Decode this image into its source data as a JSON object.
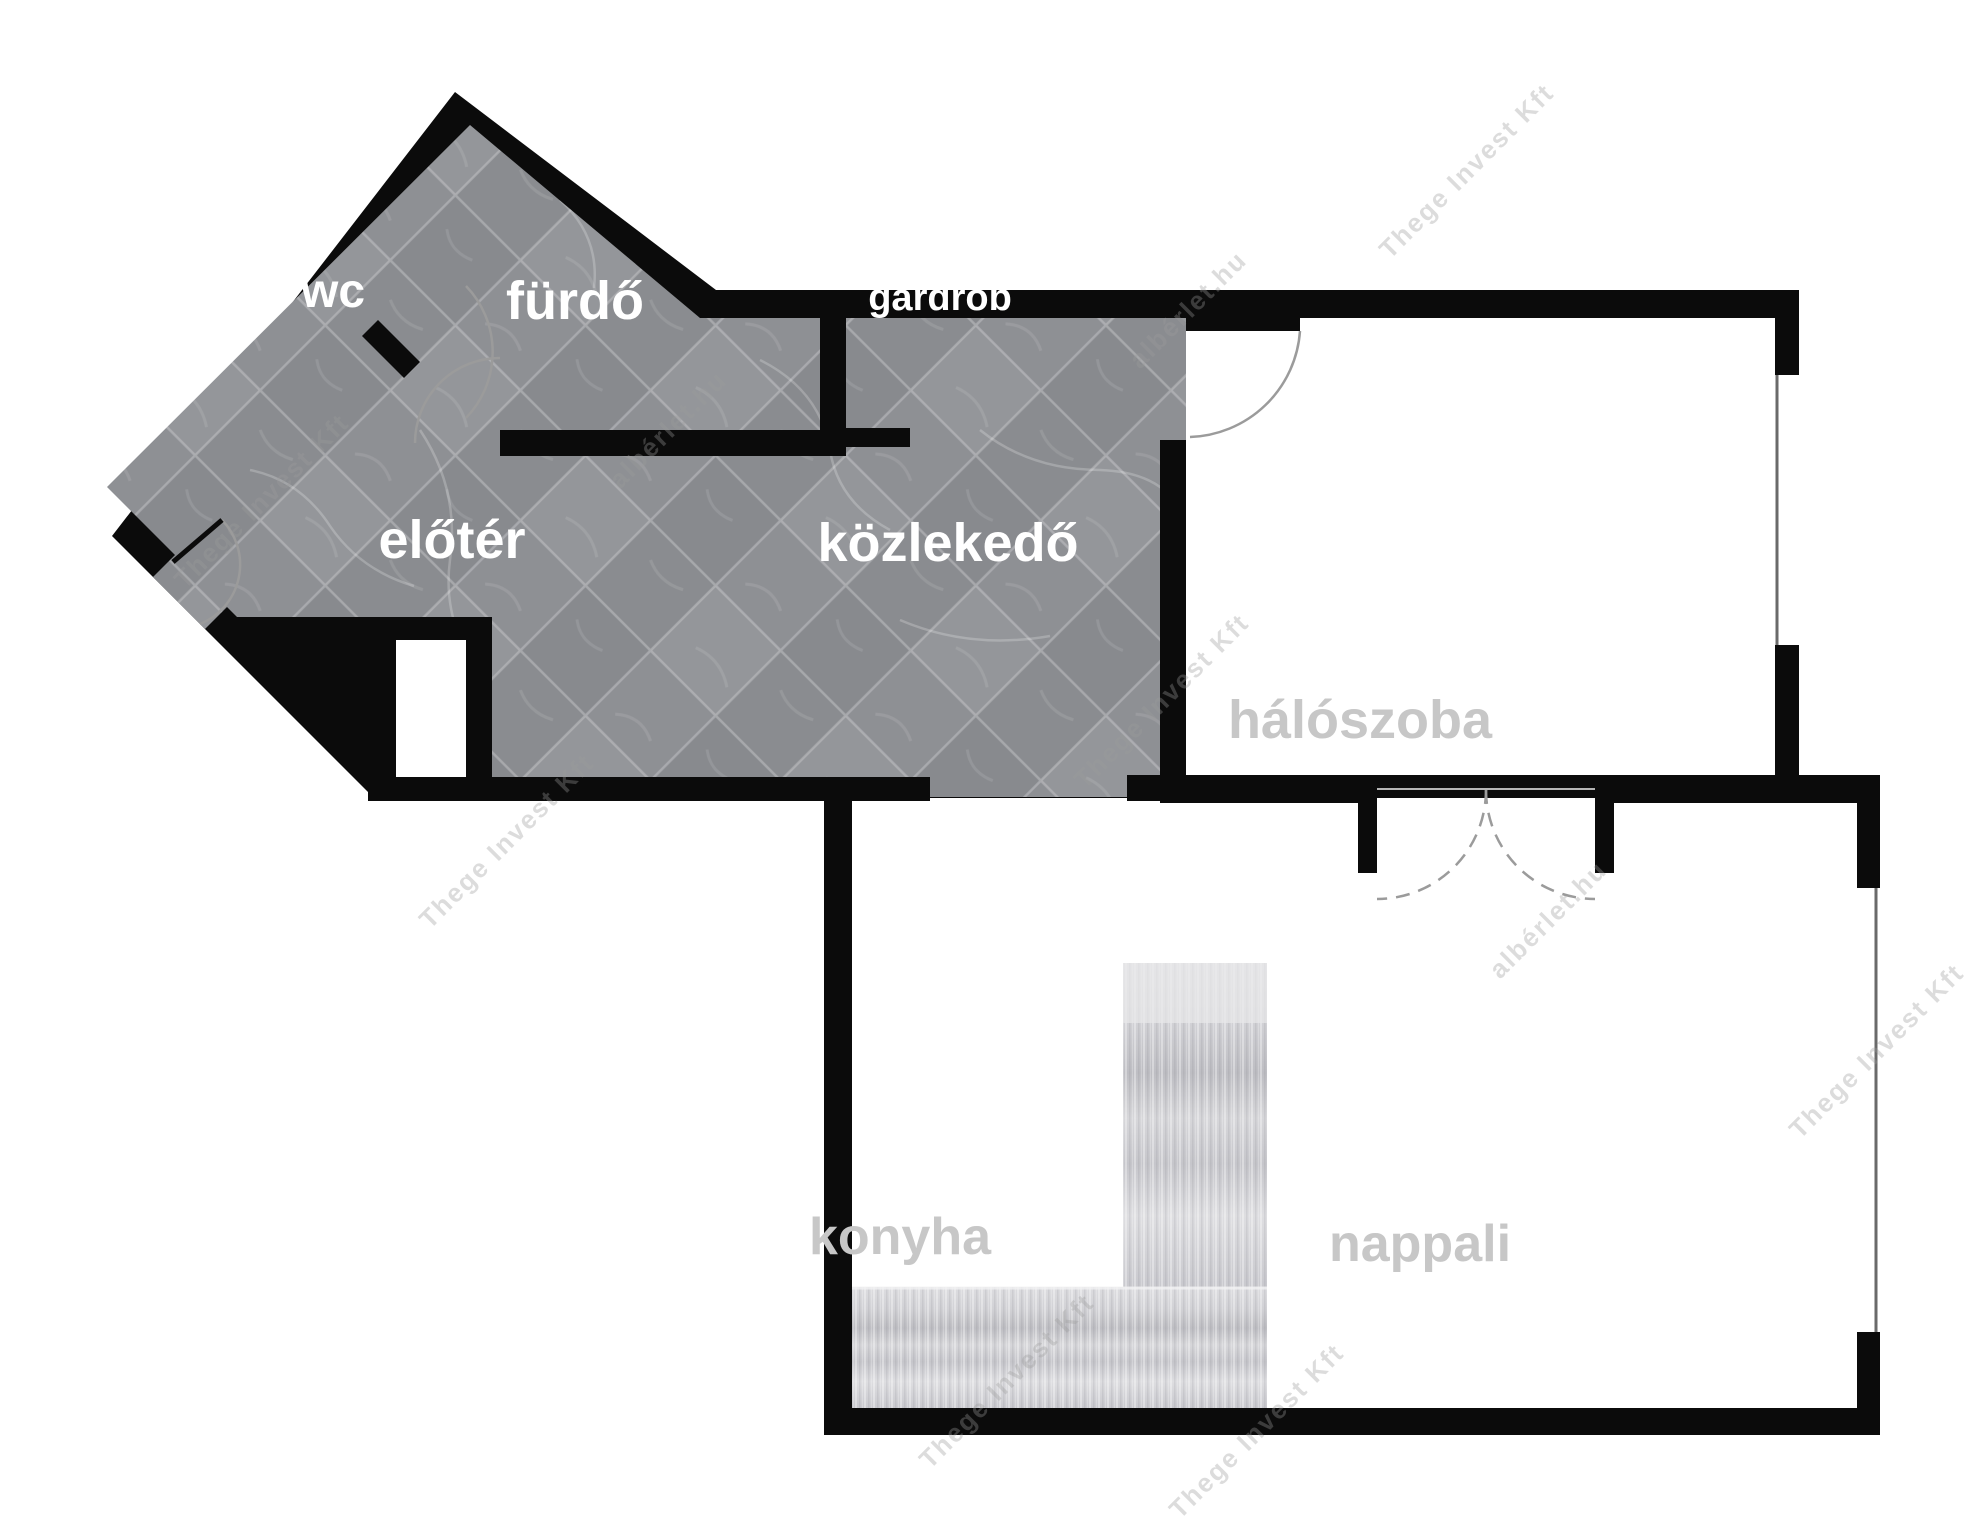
{
  "title": "apartment-floor-plan",
  "rooms": {
    "wc": {
      "label": "wc",
      "floor": "tile"
    },
    "furdo": {
      "label": "fürdő",
      "floor": "tile"
    },
    "gardrob": {
      "label": "gardrób",
      "floor": "tile"
    },
    "eloter": {
      "label": "előtér",
      "floor": "tile"
    },
    "kozlekedo": {
      "label": "közlekedő",
      "floor": "tile"
    },
    "haloszoba": {
      "label": "hálószoba",
      "floor": "white"
    },
    "konyha": {
      "label": "konyha",
      "floor": "white"
    },
    "nappali": {
      "label": "nappali",
      "floor": "white"
    }
  },
  "watermarks": {
    "brand": "Thege Invest Kft",
    "site": "albérlet.hu"
  },
  "colors": {
    "wall": "#0b0b0b",
    "tile_floor": "#8d8f93",
    "tile_grout": "#c9cacc",
    "white_floor": "#ffffff",
    "label_on_tile": "#ffffff",
    "label_on_white": "#c7c7c7",
    "door_arc": "#9b9b9b",
    "counter_light": "#e3e3e6",
    "counter_dark": "#bdbdc2",
    "window_line": "#6a6a6a"
  },
  "fixtures": {
    "doors": [
      "entry-door",
      "wc-door",
      "bathroom-door",
      "bedroom-door",
      "double-door-bedroom-living"
    ],
    "windows": [
      "bedroom-right-window",
      "living-right-window"
    ],
    "counters": [
      "kitchen-counter-vertical",
      "kitchen-counter-horizontal"
    ]
  }
}
